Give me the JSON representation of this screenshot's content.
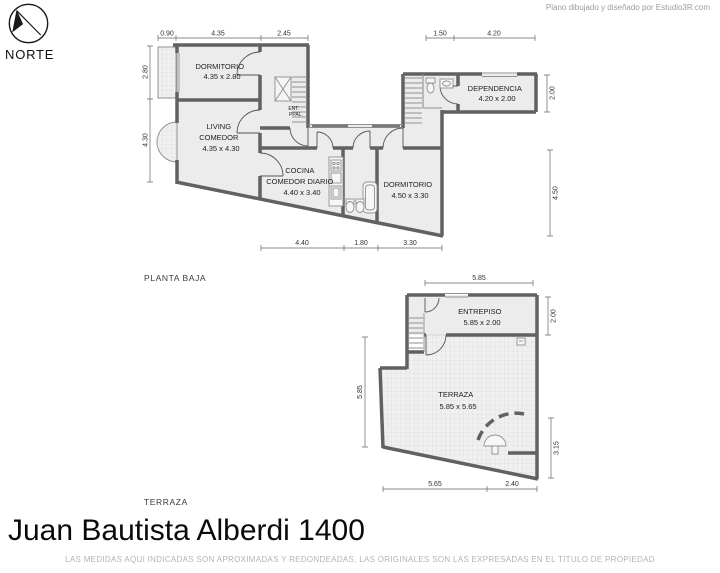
{
  "sheet": {
    "credit": "Plano dibujado y diseñado por Estudio3R.com",
    "title": "Juan Bautista Alberdi 1400",
    "footer_note": "LAS MEDIDAS AQUI INDICADAS SON APROXIMADAS Y REDONDEADAS, LAS ORIGINALES SON LAS EXPRESADAS EN EL TITULO DE PROPIEDAD",
    "north_label": "NORTE"
  },
  "plans": {
    "planta_baja": {
      "section_label": "PLANTA BAJA",
      "rooms": {
        "dormitorio_1": [
          "DORMITORIO",
          "4.35 x 2.80"
        ],
        "living_comedor": [
          "LIVING",
          "COMEDOR",
          "4.35 x 4.30"
        ],
        "cocina_comedor_diario": [
          "COCINA",
          "COMEDOR DIARIO",
          "4.40 x 3.40"
        ],
        "dormitorio_2": [
          "DORMITORIO",
          "4.50 x 3.30"
        ],
        "dependencia": [
          "DEPENDENCIA",
          "4.20 x 2.00"
        ],
        "entrada_principal": [
          "ENT.",
          "PPAL."
        ]
      },
      "dims": {
        "top": [
          "0.90",
          "4.35",
          "2.45",
          "1.50",
          "4.20"
        ],
        "left": [
          "2.80",
          "4.30"
        ],
        "right": [
          "2.00",
          "4.50"
        ],
        "bottom": [
          "4.40",
          "1.80",
          "3.30"
        ]
      }
    },
    "terraza": {
      "section_label": "TERRAZA",
      "rooms": {
        "entrepiso": [
          "ENTREPISO",
          "5.85 x 2.00"
        ],
        "terraza": [
          "TERRAZA",
          "5.85 x 5.65"
        ]
      },
      "dims": {
        "top": [
          "5.85"
        ],
        "left": [
          "5.85"
        ],
        "right": [
          "2.00",
          "3.15"
        ],
        "bottom": [
          "5.65",
          "2.40"
        ]
      }
    }
  },
  "colors": {
    "wall": "#616161",
    "room_fill": "#ececec",
    "hatch_fill": "#f0f0f0",
    "hatch_line": "#d9d9d9",
    "thin_line": "#8f8f8f",
    "dim_line": "#666666",
    "label_text": "#2b2b2b",
    "credit_text": "#9c9c9c",
    "footer_text": "#b3b3b3"
  }
}
